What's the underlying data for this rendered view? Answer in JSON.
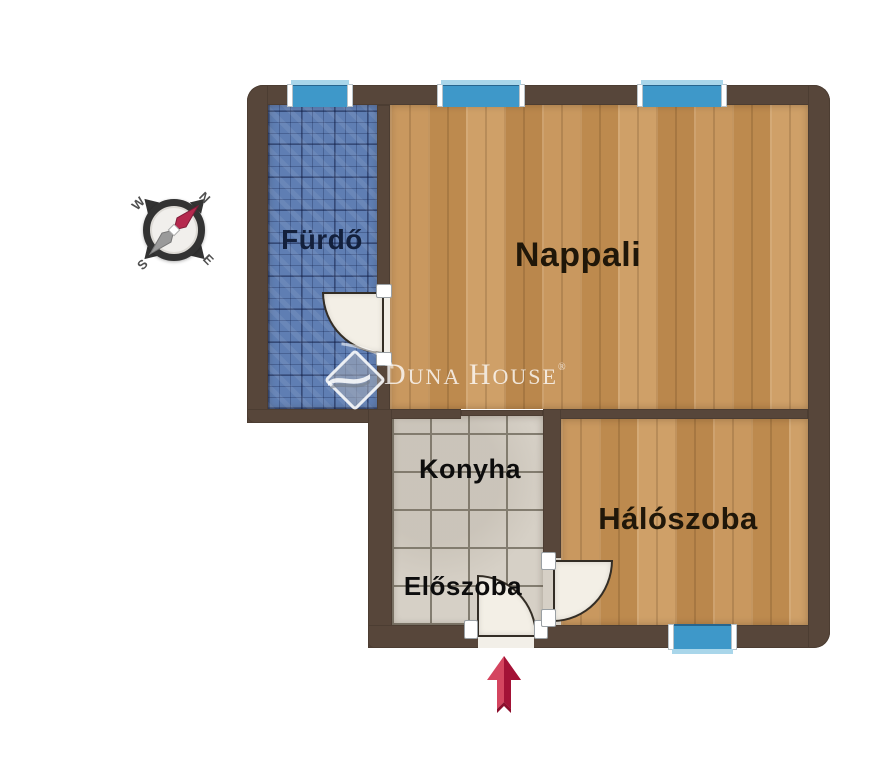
{
  "plan": {
    "rooms": [
      {
        "id": "furdo",
        "label": "Fürdő"
      },
      {
        "id": "nappali",
        "label": "Nappali"
      },
      {
        "id": "konyha",
        "label": "Konyha"
      },
      {
        "id": "eloszoba",
        "label": "Előszoba"
      },
      {
        "id": "haloszoba",
        "label": "Hálószoba"
      }
    ],
    "window_count": 4,
    "door_count": 3
  },
  "compass": {
    "letters": {
      "n": "N",
      "e": "E",
      "s": "S",
      "w": "W"
    }
  },
  "watermark": {
    "word1_initial": "D",
    "word1_rest": "UNA",
    "word2_initial": "H",
    "word2_rest": "OUSE",
    "registered": "®"
  },
  "colors": {
    "wall": "#57463a",
    "wood_floor": "#c4945a",
    "bath_tile": "#5f7eb3",
    "kitchen_tile": "#d6d0c6",
    "window_glass": "#3e98c9",
    "window_sill": "#a9d6ea",
    "door_leaf": "#f3efe6",
    "arrow_light": "#d4455f",
    "arrow_dark": "#a31236",
    "compass_needle_red": "#b5294e",
    "compass_needle_gray": "#9a9a9a",
    "background": "#ffffff"
  }
}
